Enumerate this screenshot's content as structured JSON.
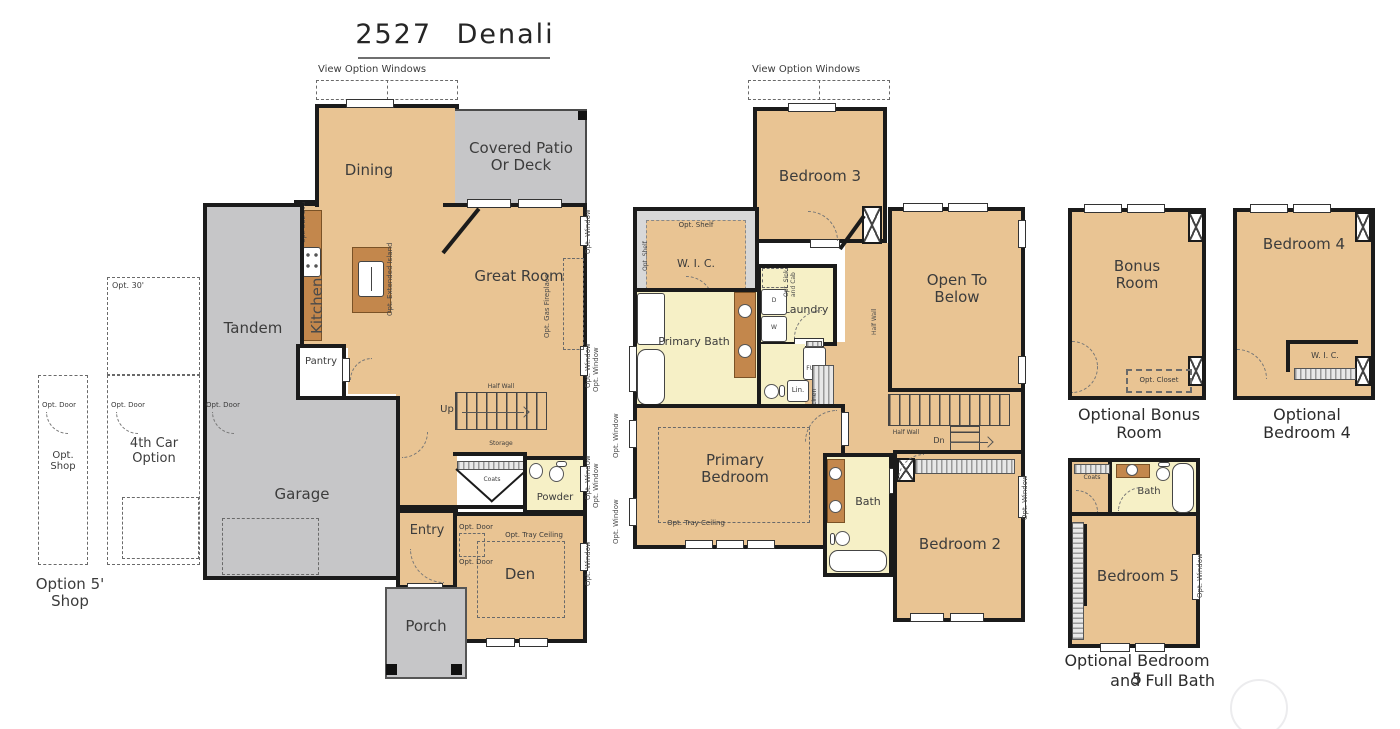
{
  "title": "2527 Denali",
  "labels": {
    "view_option_windows": "View Option Windows",
    "opt_window": "Opt. Window",
    "opt_door": "Opt. Door",
    "opt_30": "Opt. 30'",
    "opt_shop": "Opt. Shop",
    "option_5_shop": "Option 5' Shop",
    "fourth_car": "4th Car Option",
    "half_wall": "Half Wall",
    "opt_tray_ceiling": "Opt. Tray Ceiling",
    "opt_gas_fireplace": "Opt. Gas Fireplace",
    "opt_extended_island": "Opt. Extended Island",
    "opt_dbl_ovn": "Opt. DBL Ovn",
    "opt_barn_door": "Opt. Barn Door",
    "opt_shelf": "Opt. Shelf",
    "opt_sink": "Opt. Sink",
    "and_cab": "and Cab",
    "opt_closet": "Opt. Closet",
    "up": "Up",
    "dn": "Dn",
    "wh": "WH",
    "dryer": "D",
    "washer": "W",
    "furn": "FURN",
    "lin": "Lin.",
    "linen": "Linen",
    "storage": "Storage",
    "coats": "Coats"
  },
  "floor1": {
    "dining": "Dining",
    "patio": "Covered Patio Or Deck",
    "kitchen": "Kitchen",
    "great_room": "Great Room",
    "tandem": "Tandem",
    "garage": "Garage",
    "pantry": "Pantry",
    "powder": "Powder",
    "entry": "Entry",
    "den": "Den",
    "porch": "Porch"
  },
  "floor2": {
    "bedroom3": "Bedroom 3",
    "wic": "W. I. C.",
    "primary_bath": "Primary Bath",
    "laundry": "Laundry",
    "open_to_below": "Open To Below",
    "primary_bedroom": "Primary Bedroom",
    "bath": "Bath",
    "bedroom2": "Bedroom 2"
  },
  "options": {
    "bonus": {
      "name": "Bonus Room",
      "caption": "Optional Bonus Room"
    },
    "bedroom4": {
      "name": "Bedroom 4",
      "wic": "W. I. C.",
      "caption": "Optional Bedroom 4"
    },
    "bedroom5": {
      "name": "Bedroom 5",
      "bath": "Bath",
      "caption1": "Optional Bedroom 5",
      "caption2": "and Full Bath"
    }
  },
  "colors": {
    "room_tan": "#e9c493",
    "garage_gray": "#c6c6c8",
    "bath_yellow": "#f6f0c6",
    "wall": "#1b1b1b",
    "counter_brown": "#c3874c"
  }
}
